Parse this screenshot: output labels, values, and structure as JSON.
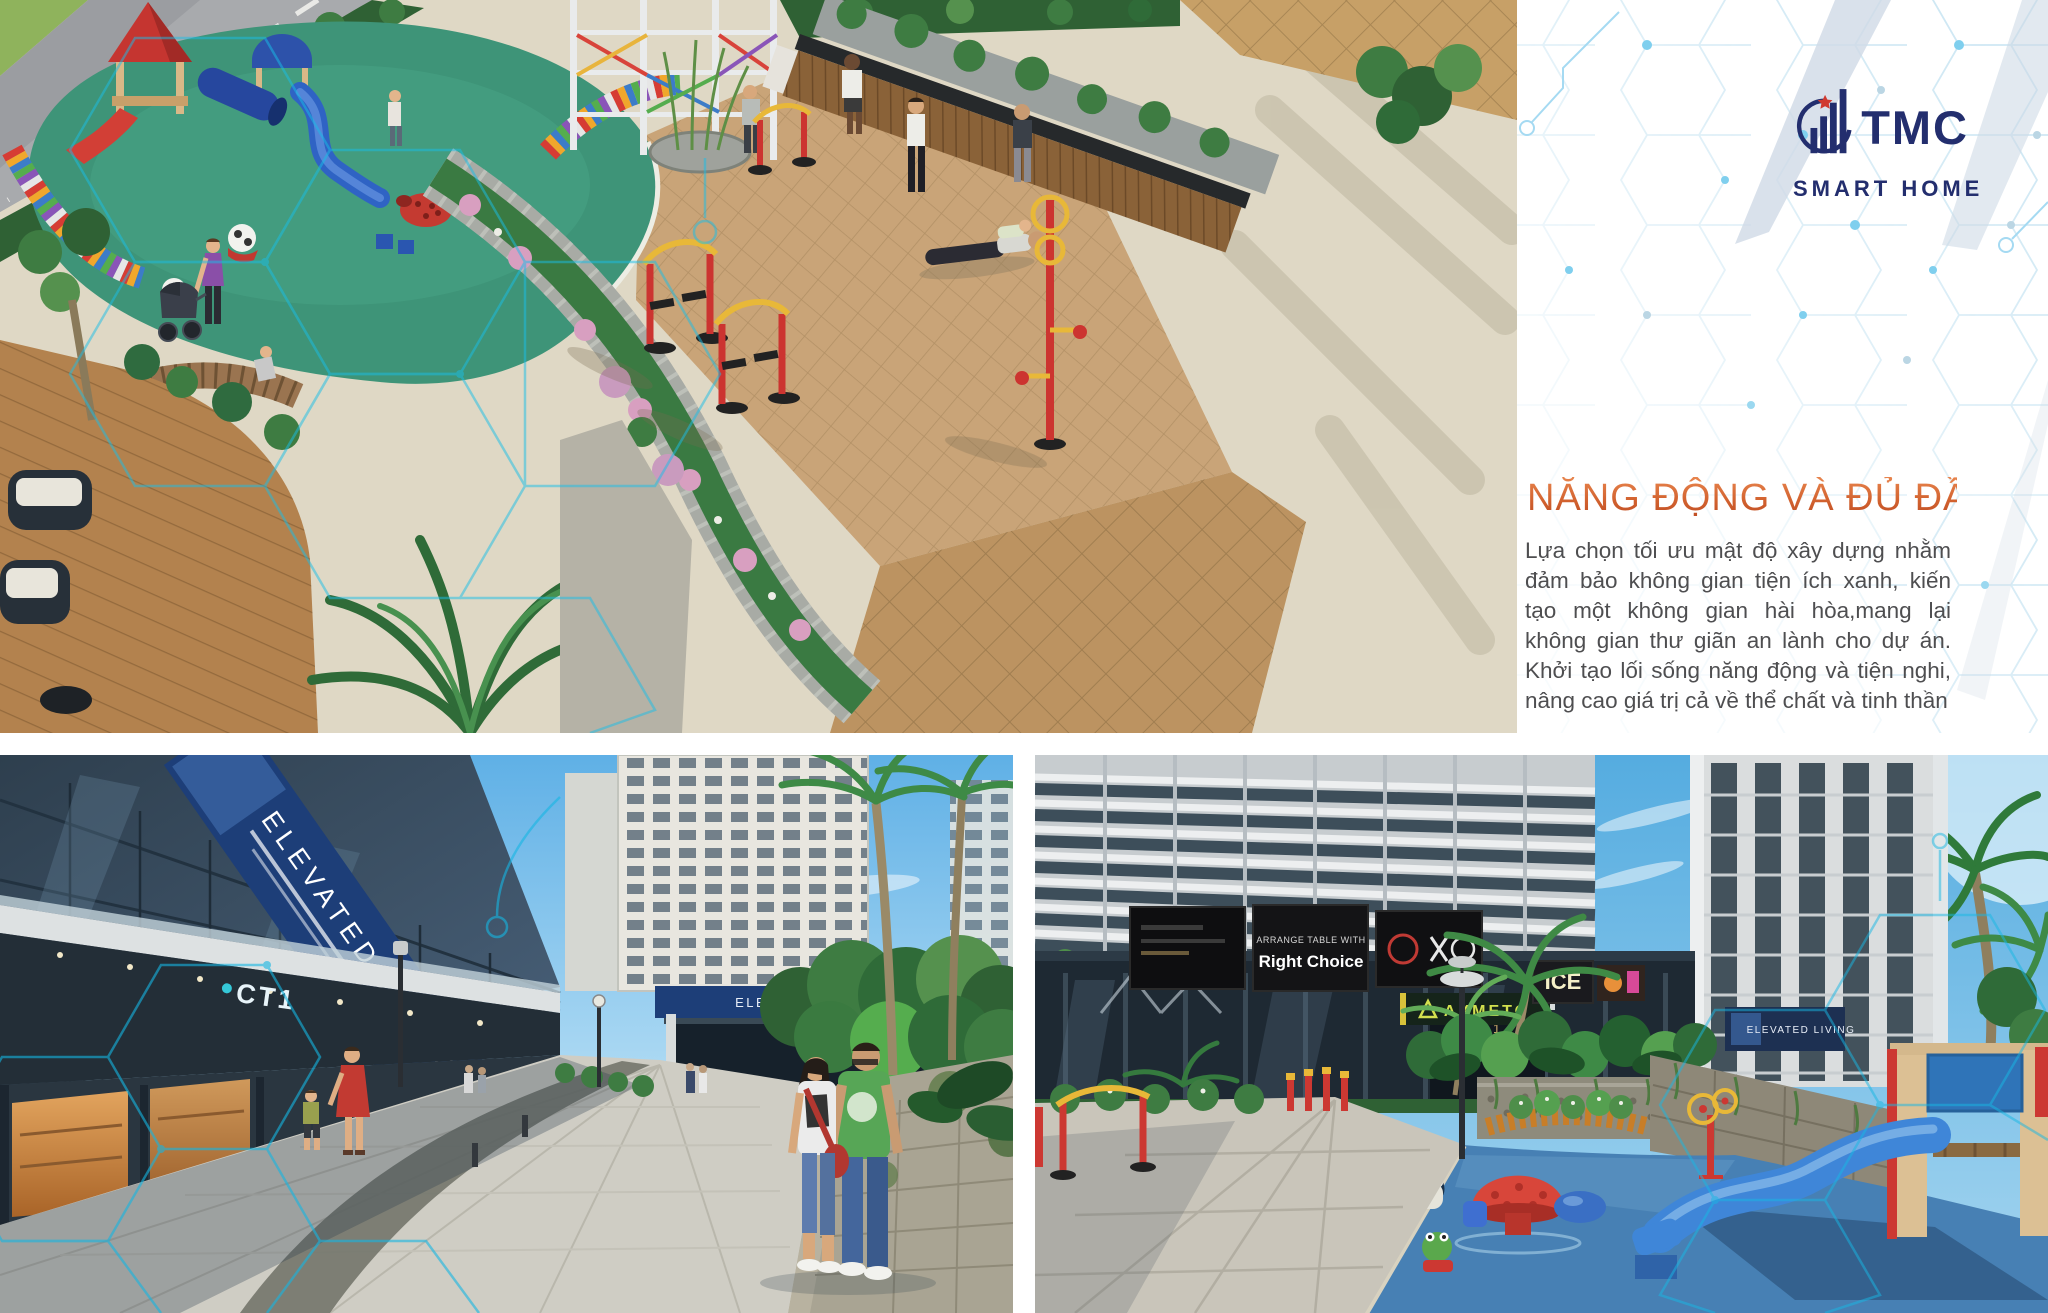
{
  "brand": {
    "name": "TMC",
    "tagline": "SMART HOME"
  },
  "panel": {
    "title": "NĂNG ĐỘNG VÀ ĐỦ ĐẦY",
    "body": "Lựa chọn tối ưu mật độ xây dựng nhằm đảm bảo không gian tiện ích xanh, kiến tạo một không gian hài hòa,mang lại không gian thư giãn an lành cho dự án. Khởi tạo lối sống năng động và tiện nghi, nâng cao giá trị cả về thể chất và tinh thần"
  },
  "signage": {
    "elevated_living": "ELEVATED LIVING",
    "ct1": "CT1",
    "arrange": "ARRANGE TABLE WITH",
    "right_choice": "Right Choice",
    "axmeto": "AXMETO",
    "ice": "ICE"
  },
  "colors": {
    "accent_orange": "#D2622F",
    "logo_navy": "#232E6E",
    "star_red": "#D03A30",
    "body_text": "#4E4E50",
    "hex_line": "#C7E4F2",
    "hex_dot": "#7FCFEE",
    "stripe_blue_gray": "#CFDAE6",
    "overlay_cyan": "#19BEE8"
  }
}
